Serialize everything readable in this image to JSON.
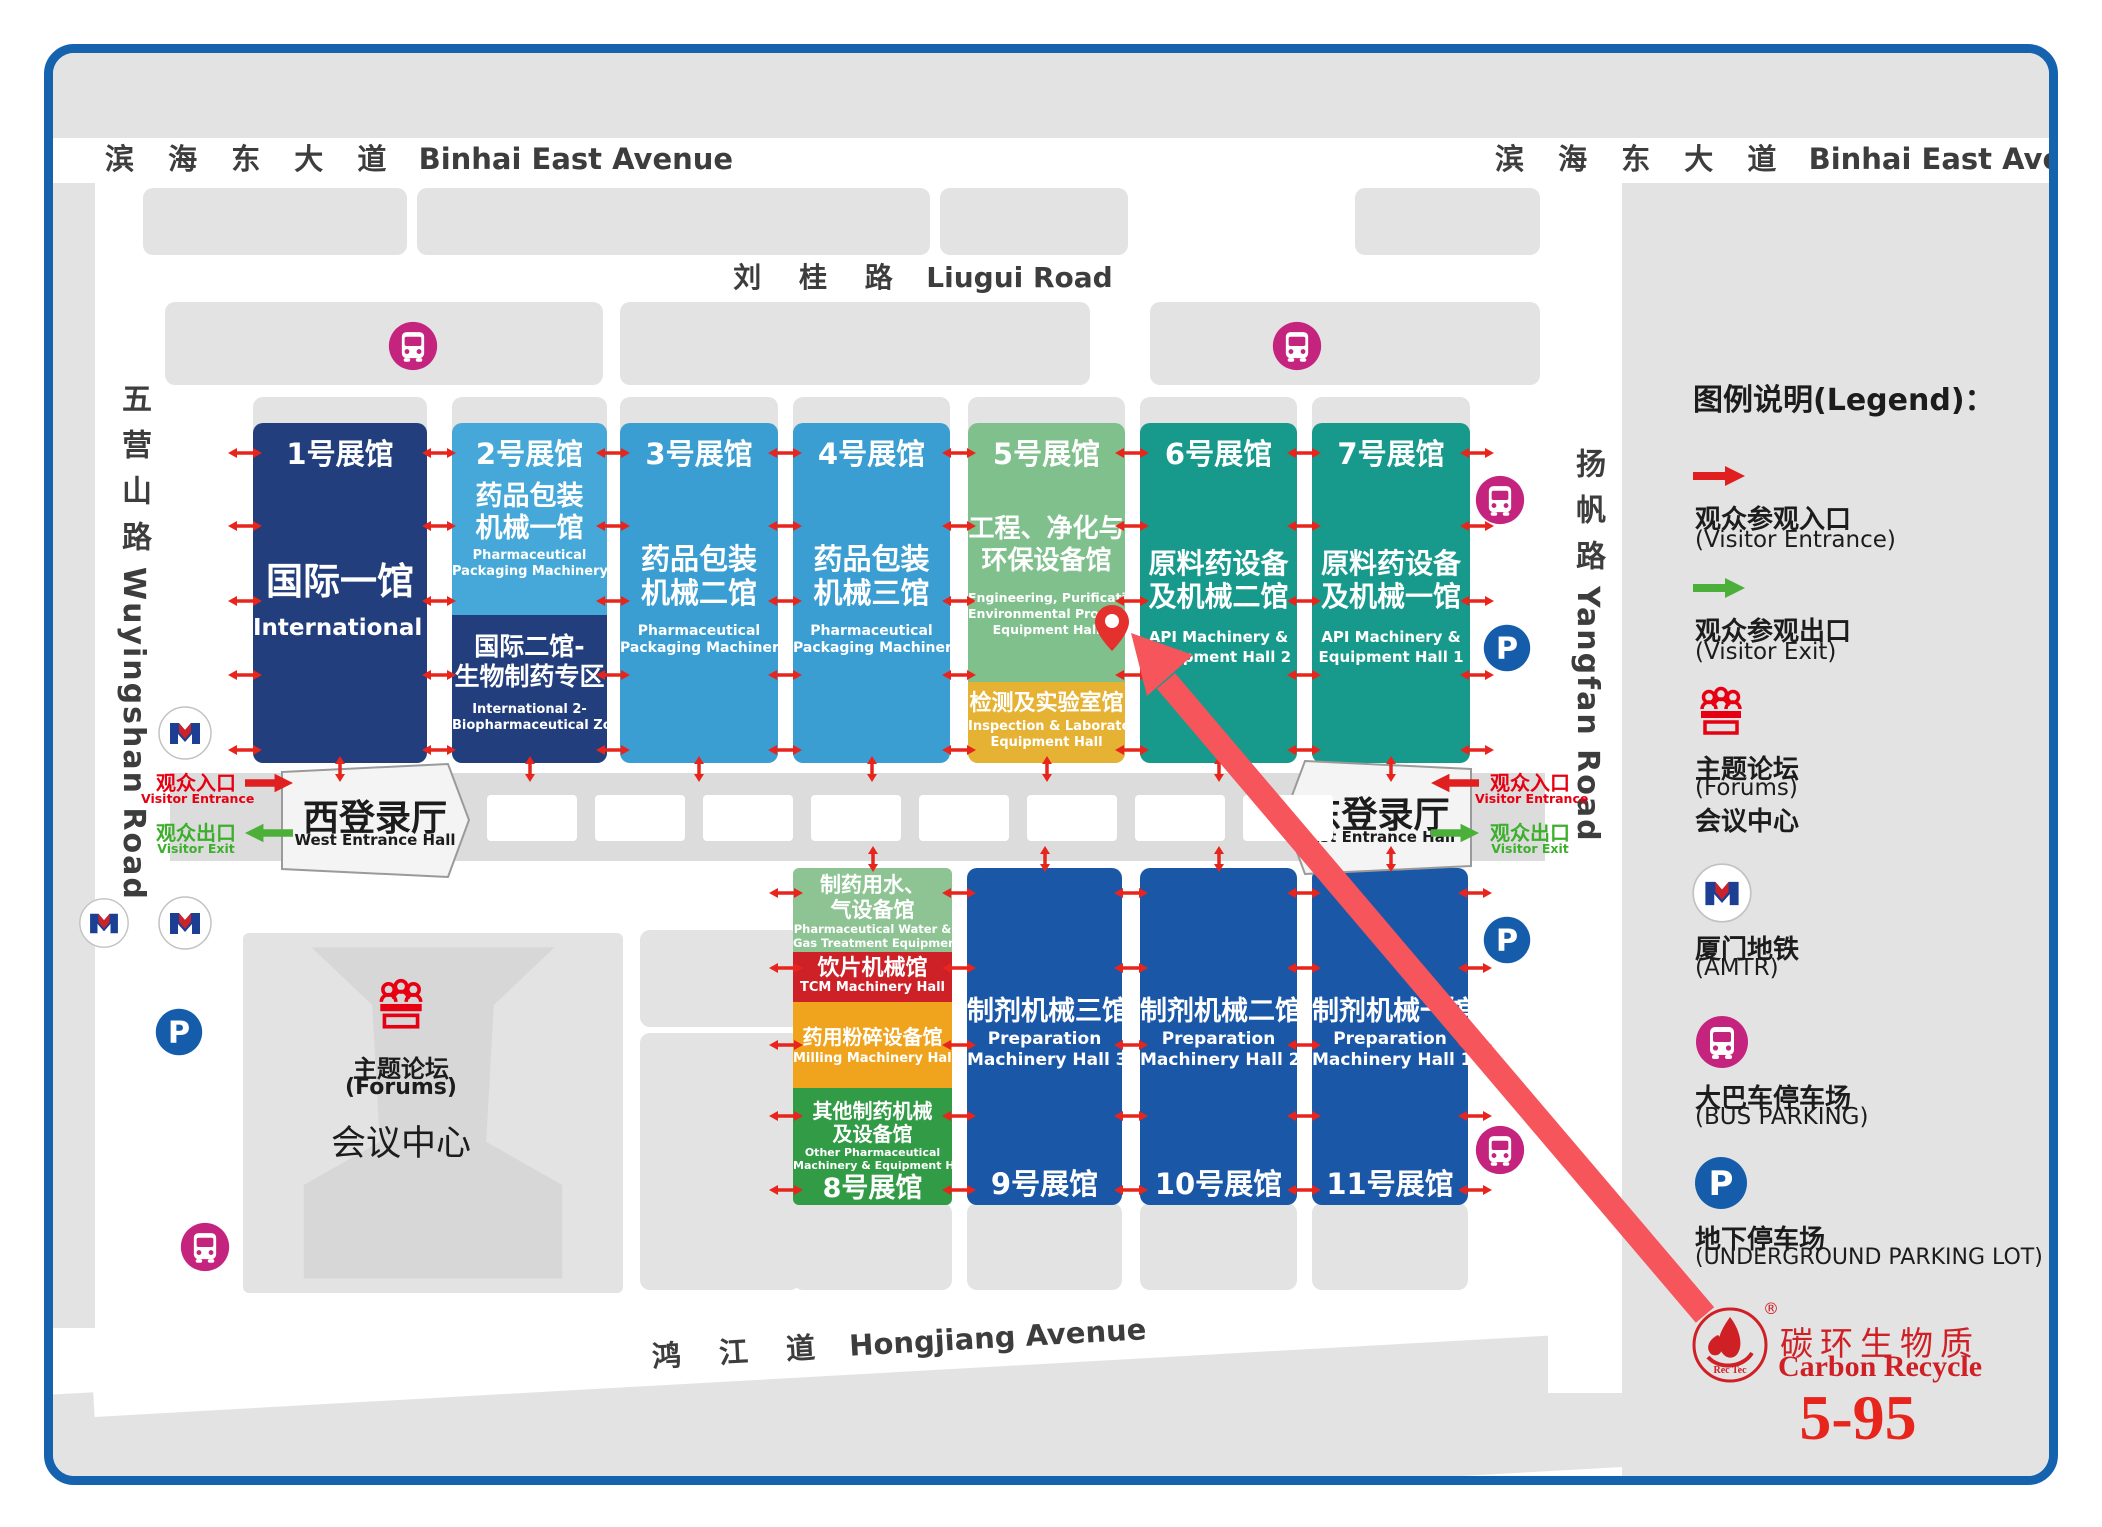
{
  "roads": {
    "binhai": {
      "zh": "滨 海 东 大 道",
      "en": "Binhai East Avenue"
    },
    "liugui": {
      "zh": "刘 桂 路",
      "en": "Liugui Road"
    },
    "hongjiang": {
      "zh": "鸿 江 道",
      "en": "Hongjiang Avenue"
    },
    "wuyingshan": {
      "zh": "五营山路",
      "en": "Wuyingshan Road"
    },
    "yangfan": {
      "zh": "扬帆路",
      "en": "Yangfan Road"
    }
  },
  "halls": {
    "h1": {
      "num": "1号展馆",
      "zh": "国际一馆",
      "en": "International 1"
    },
    "h2": {
      "num": "2号展馆",
      "zh1": "药品包装",
      "zh2": "机械一馆",
      "en1": "Pharmaceutical",
      "en2": "Packaging Machinery Hall 1"
    },
    "h2b": {
      "zh1": "国际二馆-",
      "zh2": "生物制药专区",
      "en1": "International 2-",
      "en2": "Biopharmaceutical Zone"
    },
    "h3": {
      "num": "3号展馆",
      "zh1": "药品包装",
      "zh2": "机械二馆",
      "en1": "Pharmaceutical",
      "en2": "Packaging Machinery Hall 2"
    },
    "h4": {
      "num": "4号展馆",
      "zh1": "药品包装",
      "zh2": "机械三馆",
      "en1": "Pharmaceutical",
      "en2": "Packaging Machinery Hall 3"
    },
    "h5": {
      "num": "5号展馆",
      "zh1": "工程、净化与",
      "zh2": "环保设备馆",
      "en1": "Engineering, Purification &",
      "en2": "Environmental Protection",
      "en3": "Equipment Hall"
    },
    "h5b": {
      "zh": "检测及实验室馆",
      "en1": "Inspection & Laboratory",
      "en2": "Equipment Hall"
    },
    "h6": {
      "num": "6号展馆",
      "zh1": "原料药设备",
      "zh2": "及机械二馆",
      "en1": "API Machinery &",
      "en2": "Equipment Hall 2"
    },
    "h7": {
      "num": "7号展馆",
      "zh1": "原料药设备",
      "zh2": "及机械一馆",
      "en1": "API Machinery &",
      "en2": "Equipment Hall 1"
    },
    "h8": {
      "num": "8号展馆",
      "water": {
        "zh1": "制药用水、",
        "zh2": "气设备馆",
        "en1": "Pharmaceutical Water &",
        "en2": "Gas Treatment Equipment"
      },
      "tcm": {
        "zh": "饮片机械馆",
        "en": "TCM Machinery Hall"
      },
      "milling": {
        "zh": "药用粉碎设备馆",
        "en": "Milling Machinery Hall"
      },
      "other": {
        "zh1": "其他制药机械",
        "zh2": "及设备馆",
        "en1": "Other Pharmaceutical",
        "en2": "Machinery & Equipment Hall"
      }
    },
    "h9": {
      "num": "9号展馆",
      "zh": "制剂机械三馆",
      "en1": "Preparation",
      "en2": "Machinery Hall 3"
    },
    "h10": {
      "num": "10号展馆",
      "zh": "制剂机械二馆",
      "en1": "Preparation",
      "en2": "Machinery Hall 2"
    },
    "h11": {
      "num": "11号展馆",
      "zh": "制剂机械一馆",
      "en1": "Preparation",
      "en2": "Machinery Hall 1"
    }
  },
  "entrances": {
    "west": {
      "zh": "西登录厅",
      "en": "West Entrance Hall"
    },
    "east": {
      "zh": "东登录厅",
      "en": "East Entrance Hall"
    },
    "entrance_zh": "观众入口",
    "entrance_en": "Visitor Entrance",
    "exit_zh": "观众出口",
    "exit_en": "Visitor Exit"
  },
  "forums": {
    "zh": "主题论坛",
    "en": "(Forums)",
    "center": "会议中心"
  },
  "legend": {
    "title": "图例说明(Legend)：",
    "entrance": {
      "zh": "观众参观入口",
      "en": "(Visitor Entrance)"
    },
    "exit": {
      "zh": "观众参观出口",
      "en": "(Visitor Exit)"
    },
    "forums": {
      "zh": "主题论坛",
      "en": "(Forums)",
      "extra": "会议中心"
    },
    "metro": {
      "zh": "厦门地铁",
      "en": "(AMTR)"
    },
    "bus": {
      "zh": "大巴车停车场",
      "en": "(BUS PARKING)"
    },
    "parking": {
      "zh": "地下停车场",
      "en": "(UNDERGROUND PARKING LOT)"
    }
  },
  "brand": {
    "zh": "碳环生物质",
    "en": "Carbon Recycle",
    "booth": "5-95",
    "logo_text": "Rec Tec",
    "reg": "®"
  },
  "colors": {
    "frame": "#1563ae",
    "hall_navy": "#233e7c",
    "hall_lightblue": "#45a8d8",
    "hall_blue": "#3b9ed2",
    "hall_green": "#7fc08d",
    "hall_yellow": "#e6b233",
    "hall_teal": "#179a8c",
    "hall_royal": "#1b57a7",
    "h8_red": "#cd2127",
    "h8_orange": "#f0a41d",
    "h8_green": "#319b45",
    "accent_red": "#e60012",
    "accent_green": "#3daf2c",
    "route_arrow": "#f5555b"
  }
}
